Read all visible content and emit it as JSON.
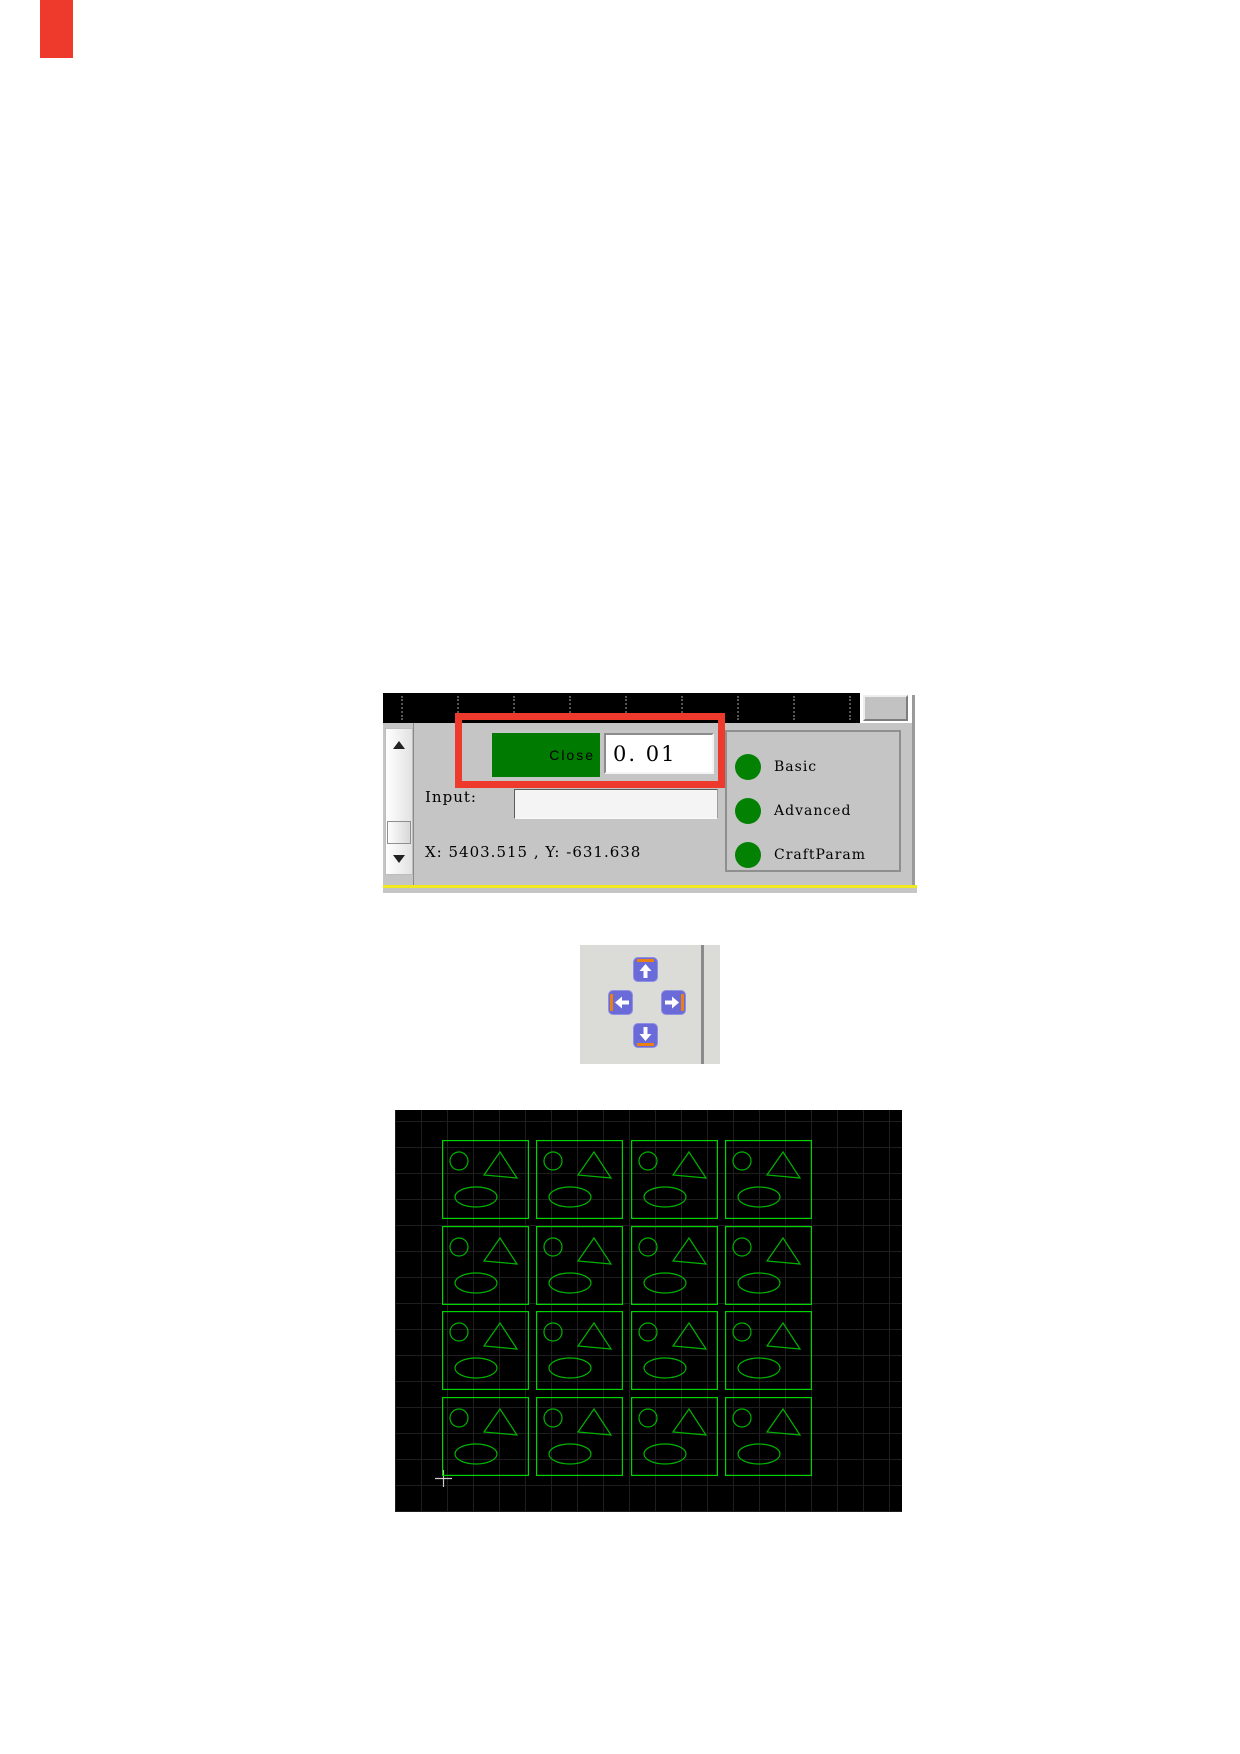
{
  "marker": {
    "color": "#ee392d"
  },
  "panel": {
    "close_button": {
      "label": "Close",
      "color": "#017a01"
    },
    "value_field": {
      "value": "0. 01"
    },
    "input": {
      "label": "Input:",
      "value": ""
    },
    "coordinates": {
      "text": "X: 5403.515 , Y: -631.638"
    },
    "radio_group": {
      "dot_color": "#028102",
      "options": [
        {
          "label": "Basic"
        },
        {
          "label": "Advanced"
        },
        {
          "label": "CraftParam"
        }
      ]
    },
    "highlight_color": "#ee392d",
    "ruler_tick_count": 9
  },
  "nav_pad": {
    "buttons": [
      "up",
      "left",
      "right",
      "down"
    ],
    "button_color": "#6a6ad8",
    "accent_color": "#ea7f12",
    "arrow_color": "#ffffff"
  },
  "canvas": {
    "background": "#000000",
    "outline_color": "#00d400",
    "shape_color": "#00b400",
    "grid": {
      "rows": 4,
      "cols": 4
    },
    "cell_shapes": [
      "circle",
      "triangle",
      "ellipse"
    ]
  }
}
